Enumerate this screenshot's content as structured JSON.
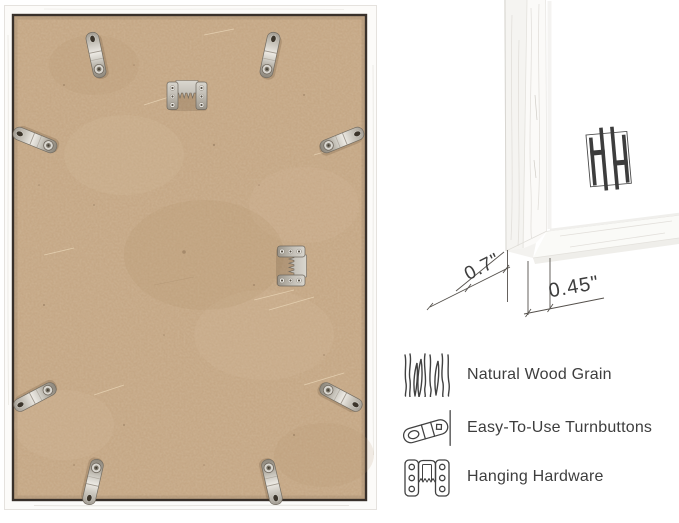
{
  "page": {
    "background": "#ffffff"
  },
  "frame_back": {
    "backing_color": "#c7a987",
    "frame_color": "#fbfaf8",
    "backing_outline_color": "#38302a",
    "hardware_color": "#cfccc4"
  },
  "closeup": {
    "depth_dimension": "0.7\"",
    "face_width_dimension": "0.45\""
  },
  "features": [
    {
      "icon": "wood-grain-icon",
      "label": "Natural Wood Grain"
    },
    {
      "icon": "turnbutton-icon",
      "label": "Easy-To-Use Turnbuttons"
    },
    {
      "icon": "hanging-hardware-icon",
      "label": "Hanging Hardware"
    }
  ]
}
